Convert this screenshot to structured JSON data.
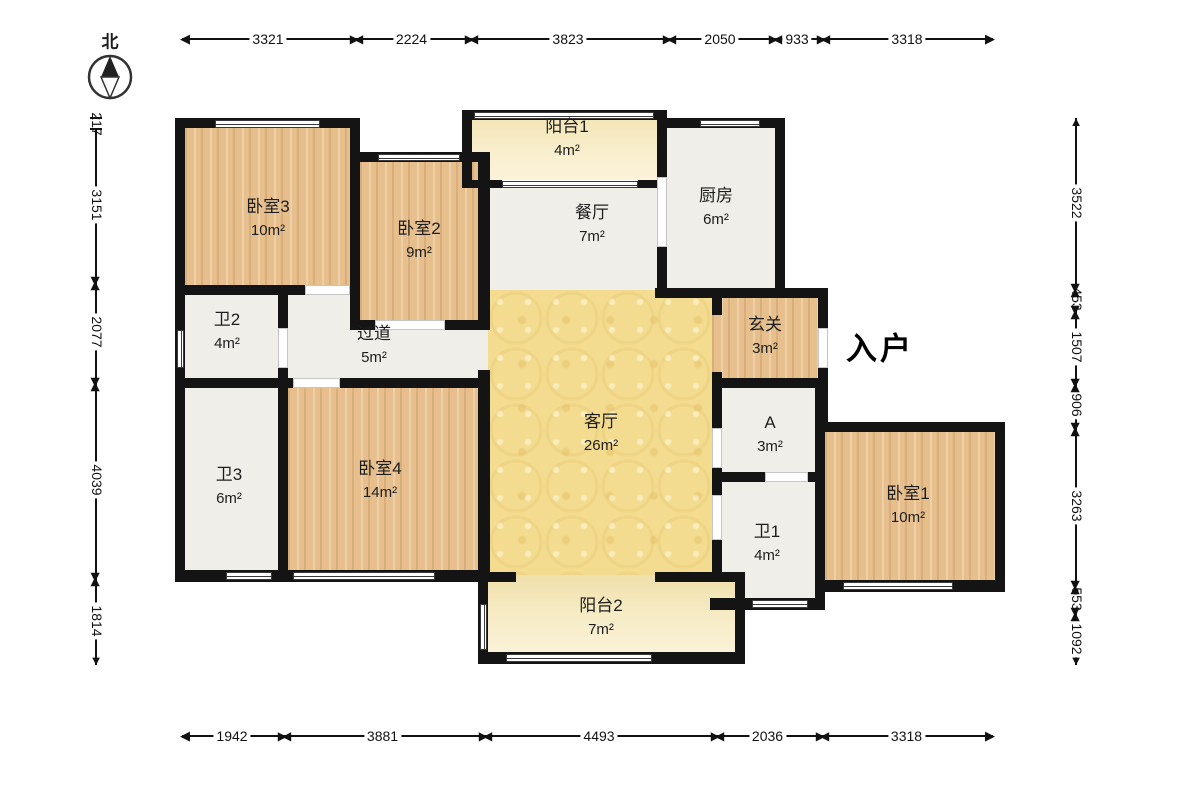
{
  "compass": {
    "label": "北"
  },
  "entry": {
    "label": "入户"
  },
  "rooms": [
    {
      "id": "bedroom3",
      "label": "卧室3",
      "area": "10m²"
    },
    {
      "id": "bedroom2",
      "label": "卧室2",
      "area": "9m²"
    },
    {
      "id": "balcony1",
      "label": "阳台1",
      "area": "4m²"
    },
    {
      "id": "dining",
      "label": "餐厅",
      "area": "7m²"
    },
    {
      "id": "kitchen",
      "label": "厨房",
      "area": "6m²"
    },
    {
      "id": "bath2",
      "label": "卫2",
      "area": "4m²"
    },
    {
      "id": "corridor",
      "label": "过道",
      "area": "5m²"
    },
    {
      "id": "hallway",
      "label": "玄关",
      "area": "3m²"
    },
    {
      "id": "roomA",
      "label": "A",
      "area": "3m²"
    },
    {
      "id": "bath1",
      "label": "卫1",
      "area": "4m²"
    },
    {
      "id": "bedroom1",
      "label": "卧室1",
      "area": "10m²"
    },
    {
      "id": "bath3",
      "label": "卫3",
      "area": "6m²"
    },
    {
      "id": "bedroom4",
      "label": "卧室4",
      "area": "14m²"
    },
    {
      "id": "living",
      "label": "客厅",
      "area": "26m²"
    },
    {
      "id": "balcony2",
      "label": "阳台2",
      "area": "7m²"
    }
  ],
  "dimensions": {
    "top": [
      "3321",
      "2224",
      "3823",
      "2050",
      "933",
      "3318"
    ],
    "bottom": [
      "1942",
      "3881",
      "4493",
      "2036",
      "3318"
    ],
    "left": [
      "217",
      "3151",
      "2077",
      "4039",
      "1814"
    ],
    "right": [
      "3522",
      "453",
      "1507",
      "906",
      "3263",
      "553",
      "1092"
    ]
  }
}
